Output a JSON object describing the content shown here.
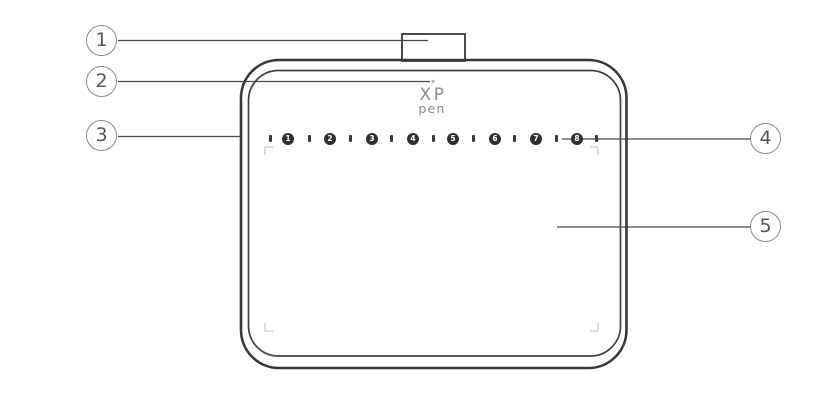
{
  "diagram": {
    "title_note": "",
    "colors": {
      "bg": "#ffffff",
      "line": "#3a3a3a",
      "leader": "#474747",
      "callout": "#8a8a8a",
      "callout_text": "#565656",
      "key_fill": "#2f2f2f",
      "key_text": "#ffffff",
      "corner_mark": "#c8c8c8",
      "logo": "#8a8a8e",
      "indicator": "#b5b5b5"
    }
  },
  "logo": {
    "line1": "XP",
    "line2": "pen"
  },
  "callouts": [
    {
      "label": "1"
    },
    {
      "label": "2"
    },
    {
      "label": "3"
    },
    {
      "label": "4"
    },
    {
      "label": "5"
    }
  ],
  "express_keys": [
    "1",
    "2",
    "3",
    "4",
    "5",
    "6",
    "7",
    "8"
  ]
}
